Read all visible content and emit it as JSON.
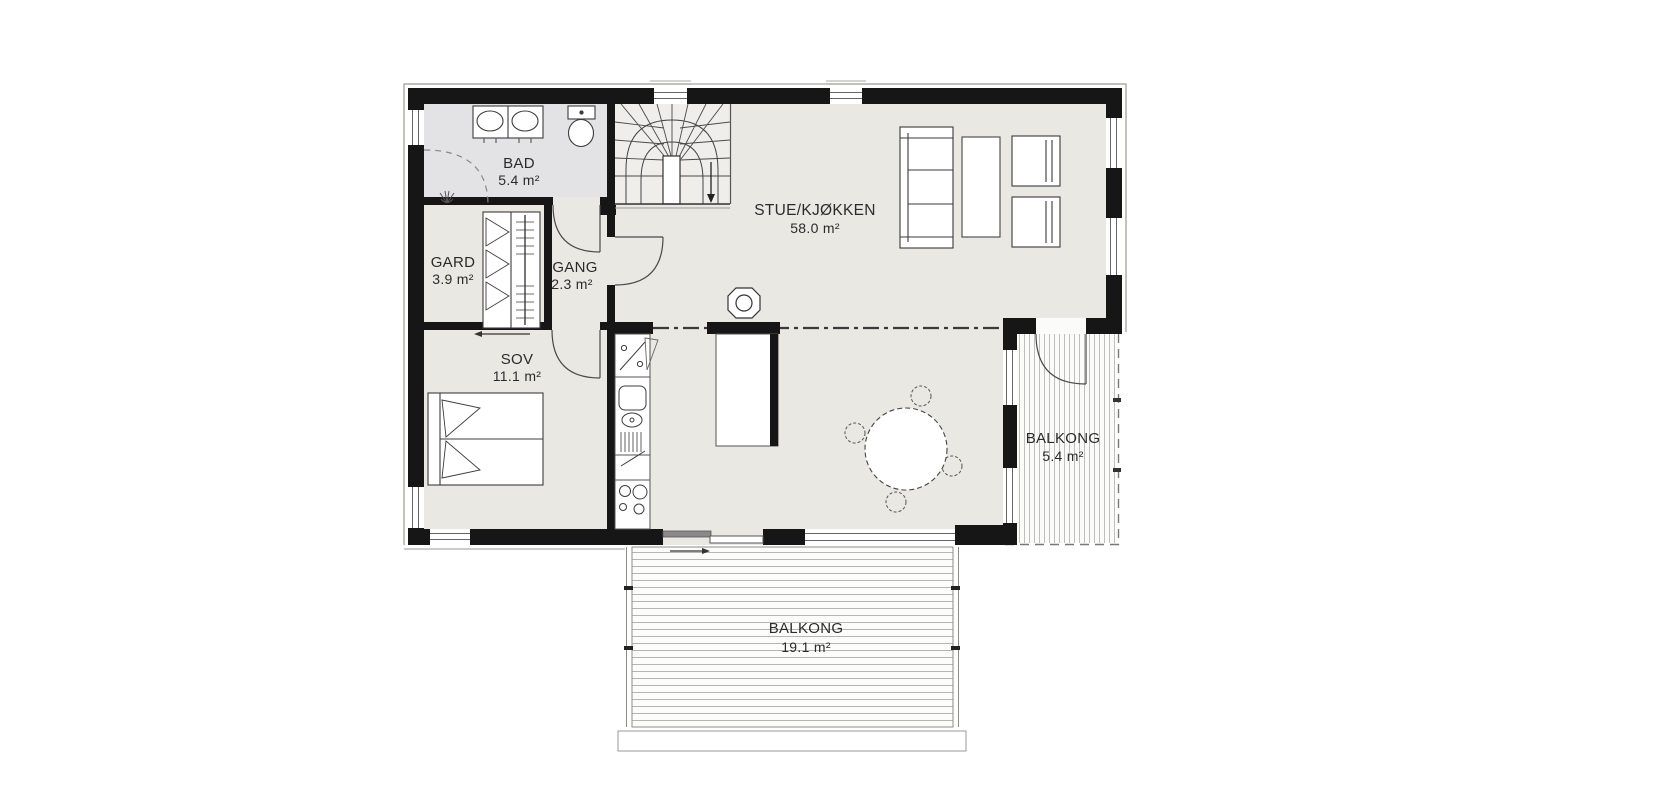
{
  "rooms": {
    "bad": {
      "name": "BAD",
      "area": "5.4 m²"
    },
    "gard": {
      "name": "GARD",
      "area": "3.9 m²"
    },
    "gang": {
      "name": "GANG",
      "area": "2.3 m²"
    },
    "sov": {
      "name": "SOV",
      "area": "11.1 m²"
    },
    "stue_kjokken": {
      "name": "STUE/KJØKKEN",
      "area": "58.0 m²"
    },
    "balkong_east": {
      "name": "BALKONG",
      "area": "5.4 m²"
    },
    "balkong_south": {
      "name": "BALKONG",
      "area": "19.1 m²"
    }
  },
  "colors": {
    "wall": "#161616",
    "floor": "#e9e8e3",
    "floor_bath": "#e3e3e5",
    "deck_board_line": "#b6b6b0",
    "label_text": "#2b2b2b",
    "background": "#ffffff"
  },
  "symbols": [
    "winder-staircase",
    "toilet",
    "double-sink-vanity",
    "corner-shower",
    "floor-drain",
    "wardrobe-cabinet",
    "double-bed",
    "kitchen-counter",
    "dishwasher",
    "kitchen-sink",
    "cooktop",
    "fridge-door-swing",
    "kitchen-island",
    "wood-stove",
    "sofa",
    "coffee-table",
    "armchair",
    "round-dining-table",
    "dining-chair",
    "sliding-door",
    "hinged-door",
    "window",
    "section-line",
    "deck-boards"
  ]
}
